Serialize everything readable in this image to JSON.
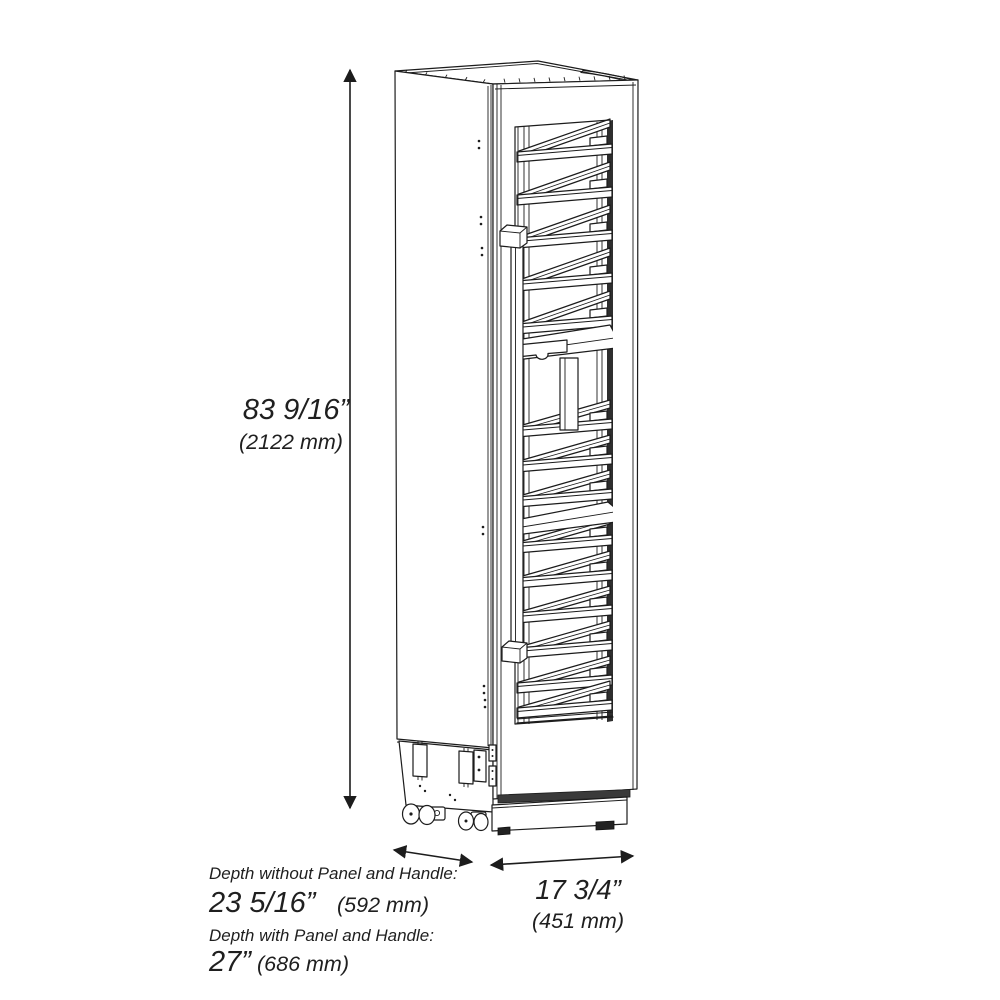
{
  "dimensions": {
    "height": {
      "imperial": "83 9/16”",
      "metric": "(2122 mm)"
    },
    "width": {
      "imperial": "17 3/4”",
      "metric": "(451 mm)"
    },
    "depth_without_panel": {
      "caption": "Depth without Panel and Handle:",
      "imperial": "23 5/16”",
      "metric": "(592 mm)"
    },
    "depth_with_panel": {
      "caption": "Depth with Panel and Handle:",
      "imperial": "27”",
      "metric": "(686 mm)"
    }
  },
  "colors": {
    "line": "#1c1c1c",
    "background": "#ffffff",
    "shadow_band": "#2e2e2e"
  }
}
